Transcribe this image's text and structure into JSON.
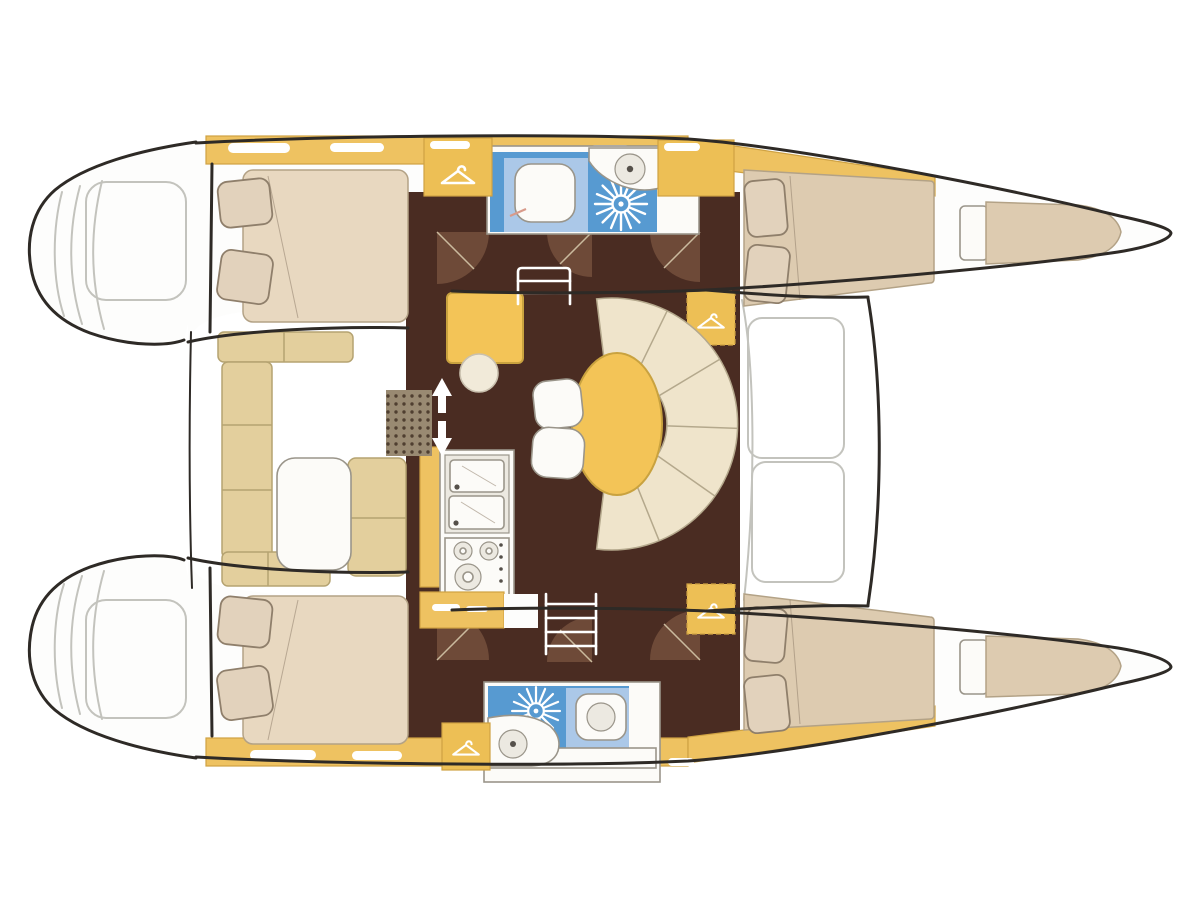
{
  "diagram": {
    "type": "boat-floor-plan",
    "subject": "catamaran interior layout, top view, bows pointing right",
    "rooms": [
      {
        "name": "upper-aft-cabin",
        "features": [
          "double-bed",
          "two-pillows",
          "wardrobe"
        ]
      },
      {
        "name": "upper-bathroom",
        "features": [
          "toilet",
          "shower",
          "round-sink"
        ]
      },
      {
        "name": "upper-forward-cabin",
        "features": [
          "double-bed",
          "two-pillows"
        ]
      },
      {
        "name": "upper-bow-berth",
        "features": [
          "single-berth",
          "headboard"
        ]
      },
      {
        "name": "lower-aft-cabin",
        "features": [
          "double-bed",
          "two-pillows",
          "wardrobe"
        ]
      },
      {
        "name": "lower-bathroom",
        "features": [
          "toilet",
          "shower",
          "round-sink"
        ]
      },
      {
        "name": "lower-forward-cabin",
        "features": [
          "double-bed",
          "two-pillows"
        ]
      },
      {
        "name": "lower-bow-berth",
        "features": [
          "single-berth",
          "headboard"
        ]
      },
      {
        "name": "saloon",
        "features": [
          "oval-table",
          "curved-fan-settee",
          "two-stools",
          "nav-desk",
          "nav-stool"
        ]
      },
      {
        "name": "galley",
        "features": [
          "double-sink",
          "stove-three-burners",
          "counters"
        ]
      },
      {
        "name": "cockpit",
        "features": [
          "c-shaped-bench",
          "cockpit-table",
          "deck-grate"
        ]
      },
      {
        "name": "foredeck",
        "features": [
          "trampoline",
          "two-hatches"
        ]
      },
      {
        "name": "stern-platforms",
        "features": [
          "steps-sketch"
        ]
      }
    ],
    "icons": [
      {
        "name": "hanger-icon",
        "count": 4,
        "meaning": "wardrobe"
      },
      {
        "name": "shower-icon",
        "count": 2,
        "meaning": "shower drain starburst"
      },
      {
        "name": "steps-icon",
        "count": 2,
        "meaning": "companionway steps"
      },
      {
        "name": "arrow-up-down",
        "count": 1,
        "meaning": "companionway direction"
      }
    ]
  },
  "colors": {
    "background": "#ffffff",
    "hull_outline": "#2e2a26",
    "hull_white": "#fdfdfc",
    "sketch_gray": "#c3c3bd",
    "deck_yellow": "#eec261",
    "cabinet_yellow": "#edbf55",
    "deck_border": "#cfa243",
    "floor_brown": "#4a2c22",
    "door_brown": "#6e4a38",
    "door_leaf": "#caba9e",
    "bed_beige": "#e8d8c0",
    "bed_tan": "#ddcbb0",
    "bed_stroke": "#b3a286",
    "pillow": "#e2d2bc",
    "pillow_stroke": "#8f7f6b",
    "settee_cream": "#efe4cb",
    "settee_stroke": "#b4a88c",
    "cockpit_tan": "#e3cf9d",
    "cockpit_stroke": "#b5a371",
    "bath_blue": "#579ad1",
    "bath_blue_light": "#abc8e8",
    "fixture_white": "#fcfbf8",
    "fixture_inner": "#ece9e1",
    "fixture_stroke": "#9a958a",
    "white": "#ffffff",
    "table_yellow": "#f3c457",
    "table_border": "#c9a23f",
    "stool_cream": "#f1ead9",
    "stool_stroke": "#c9c0ae",
    "grate_base": "#998a72",
    "grate_dot": "#4f3f30",
    "knob_dark": "#55504a"
  }
}
